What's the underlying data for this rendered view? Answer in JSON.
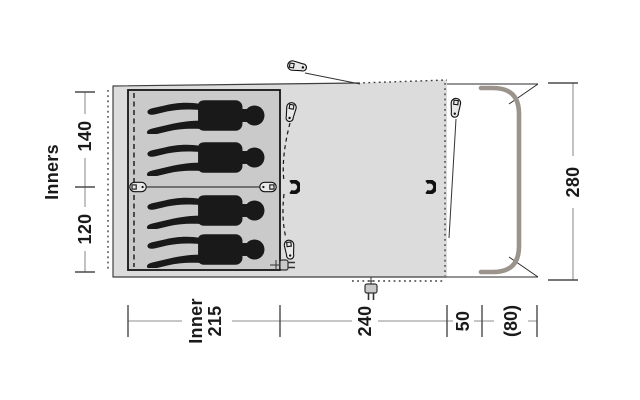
{
  "labels": {
    "inners": "Inners",
    "sec140": "140",
    "sec120": "120",
    "depth280": "280",
    "inner_w1": "Inner",
    "inner_w2": "215",
    "width240": "240",
    "porch50": "50",
    "canopy80": "(80)"
  },
  "occupants": 4,
  "icons": {
    "zipper_pull": "zipper-pull-icon",
    "toggle_clip": "toggle-clip-icon",
    "hanging_hook": "hook-icon",
    "power_inlet": "plug-icon",
    "front_pole": "front-pole"
  },
  "colors": {
    "body": "#dcdcdc",
    "inner": "#cacaca",
    "silhouette": "#191919",
    "pole": "#9b948c",
    "line": "#3f3f3f",
    "dim": "#8f8f8f",
    "tick": "#4a4a4a",
    "text": "#1a1a1a"
  }
}
